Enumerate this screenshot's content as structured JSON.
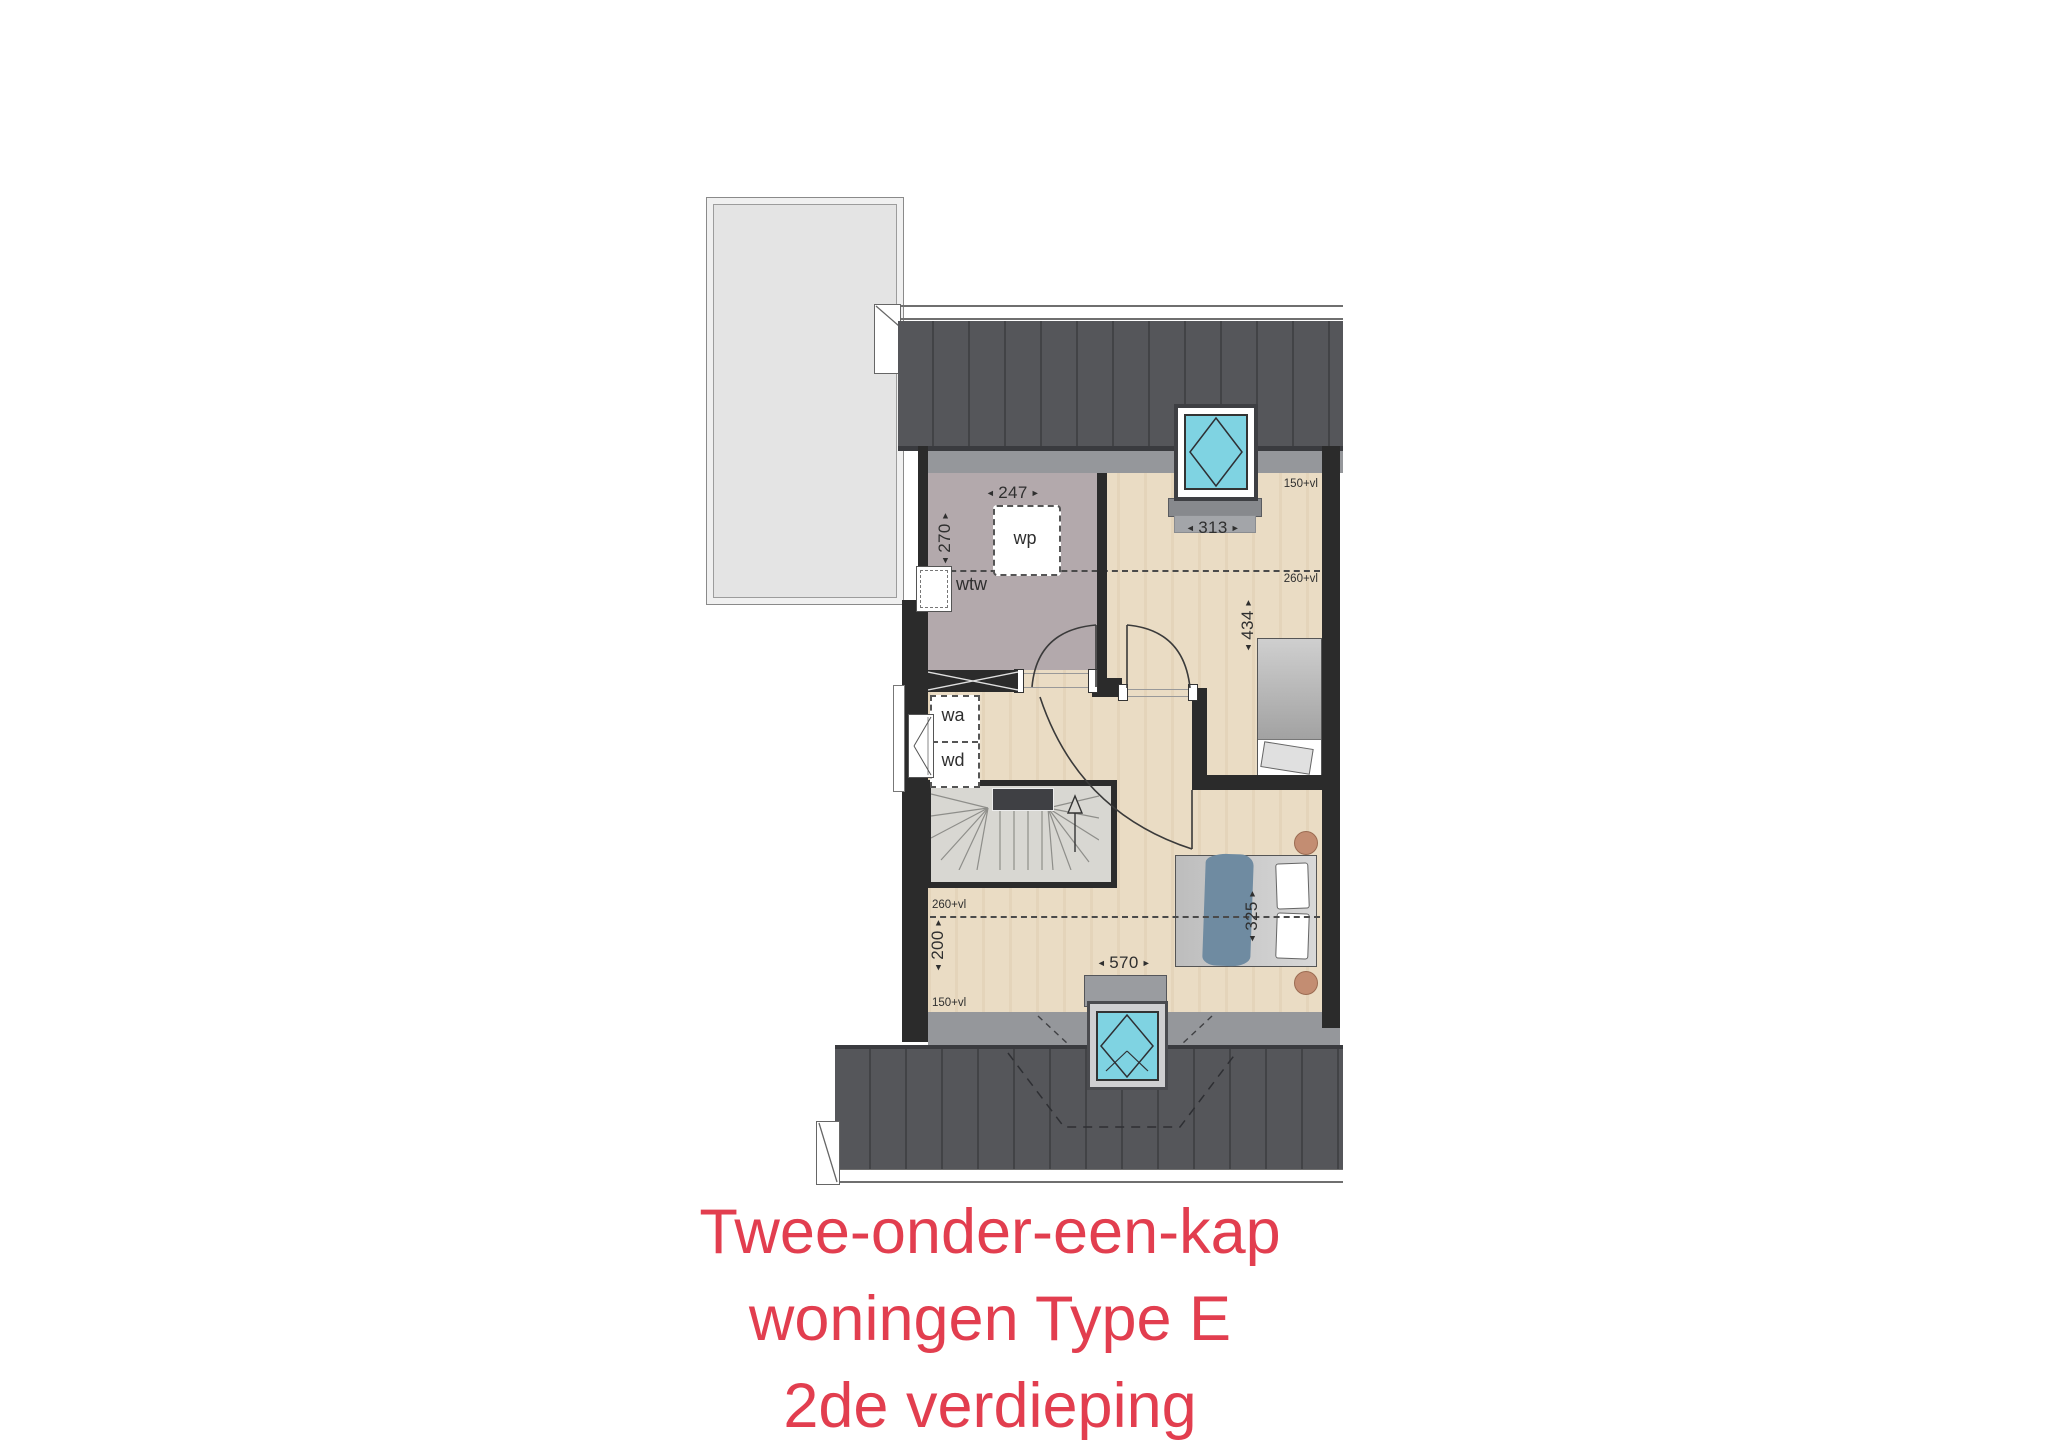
{
  "title": {
    "line1": "Twee-onder-een-kap",
    "line2": "woningen Type E",
    "line3": "2de verdieping"
  },
  "plan": {
    "arrows": {
      "left": "◄",
      "right": "►"
    },
    "rooms": {
      "technical": {
        "width": "247",
        "depth": "270",
        "equipment_wp": "wp",
        "equipment_wtw": "wtw"
      },
      "bedroom_top": {
        "width": "313",
        "depth": "434"
      },
      "landing": {
        "washer": "wa",
        "dryer": "wd"
      },
      "bedroom_bottom": {
        "width": "570",
        "bed_width": "325",
        "left_depth": "200"
      }
    },
    "height_markers": {
      "top_right": "150+vl",
      "mid_right": "260+vl",
      "mid_left": "260+vl",
      "bottom_left": "150+vl"
    }
  },
  "colors": {
    "title_accent": "#e23e4f",
    "roof_dark": "#55565a",
    "eave_gray": "#95979b",
    "wall": "#2b2b2b",
    "floor_wood": "#eadcc4",
    "floor_technical": "#b3a9ac",
    "skylight_glass": "#7fd3e2",
    "bed_blanket_blue": "#6f8ba1",
    "nightstand": "#c38d72"
  }
}
